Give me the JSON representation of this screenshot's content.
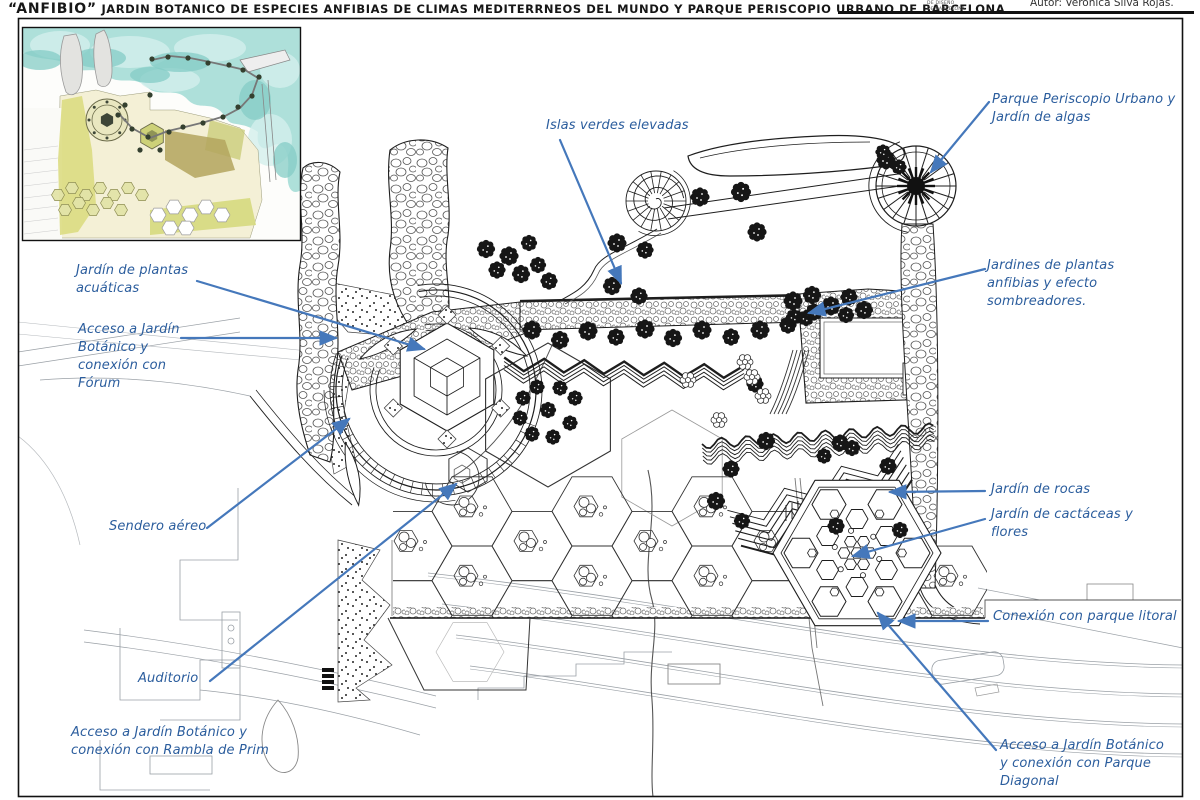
{
  "header": {
    "title_name": "“ANFIBIO”",
    "title_rest": "JARDIN BOTANICO DE ESPECIES ANFIBIAS DE CLIMAS MEDITERRNEOS DEL MUNDO Y PARQUE PERISCOPIO URBANO DE BARCELONA",
    "logo_line1": "DE DISEÑO",
    "logo_line2": "DE BARCELONA",
    "author": "Autor: Verónica Silva Rojas."
  },
  "annotations": [
    {
      "id": "islas-verdes",
      "text": "Islas verdes elevadas"
    },
    {
      "id": "periscopio",
      "text": "Parque Periscopio Urbano y Jardín de algas"
    },
    {
      "id": "plantas-acuaticas",
      "text": "Jardín de plantas acuáticas"
    },
    {
      "id": "acceso-forum",
      "text": "Acceso a Jardín Botánico y conexión con Fórum"
    },
    {
      "id": "plantas-anfibias",
      "text": "Jardines de plantas anfibias y efecto sombreadores."
    },
    {
      "id": "sendero-aereo",
      "text": "Sendero aéreo"
    },
    {
      "id": "jardin-rocas",
      "text": "Jardín de rocas"
    },
    {
      "id": "cactaceas",
      "text": "Jardín de cactáceas y flores"
    },
    {
      "id": "parque-litoral",
      "text": "Conexión con parque litoral"
    },
    {
      "id": "auditorio",
      "text": "Auditorio"
    },
    {
      "id": "rambla-prim",
      "text": "Acceso a Jardín Botánico y conexión con Rambla de Prim"
    },
    {
      "id": "parque-diagonal",
      "text": "Acceso a Jardín Botánico y conexión con Parque Diagonal"
    }
  ],
  "colors": {
    "annotation_text": "#2b5d9d",
    "leader_line": "#4578bb",
    "ink": "#1e1e1e",
    "faint": "#9aa0a6",
    "water": "#aee0da",
    "land": "#f4f0d6",
    "garden_green": "#dcdc82"
  }
}
